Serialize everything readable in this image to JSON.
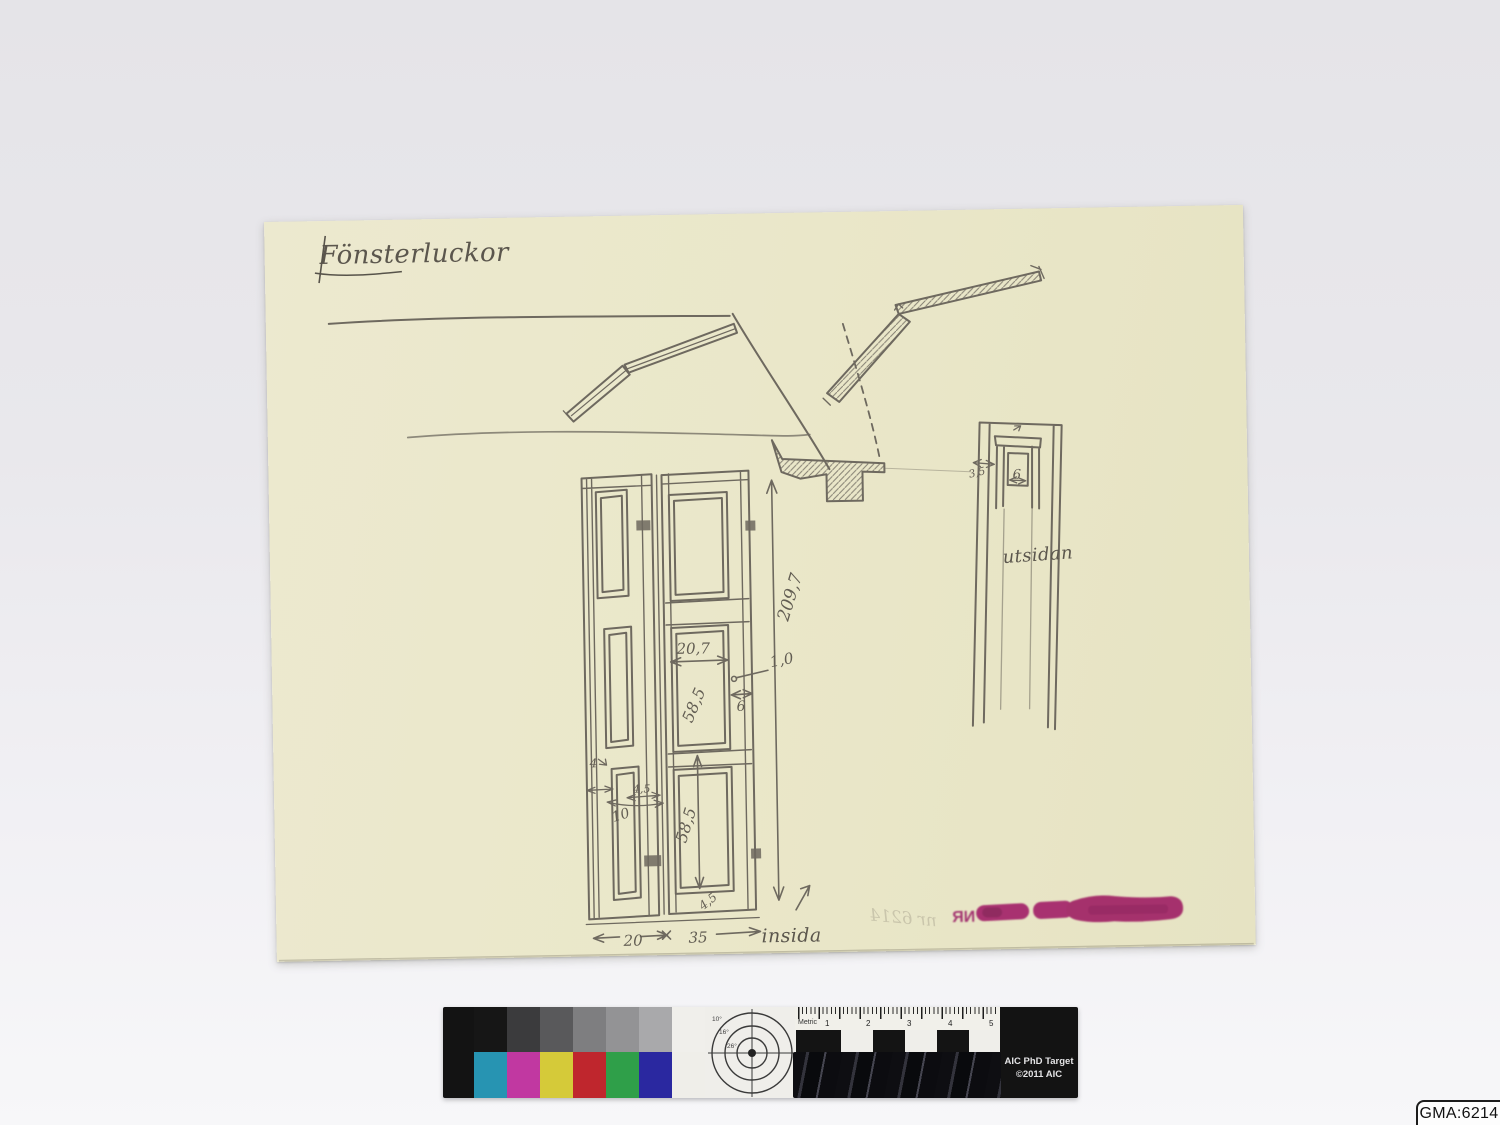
{
  "photo": {
    "background_top": "#e5e4e8",
    "background_bottom": "#f7f7f9"
  },
  "archive_label": {
    "text": "GMA:6214"
  },
  "sketch": {
    "title": "Fönsterluckor",
    "paper_color": "#eae7c9",
    "pencil_color": "#6e695f",
    "labels": {
      "inside": "insida",
      "outside": "utsidan"
    },
    "dimensions": {
      "total_height": "209,7",
      "panel_width": "20,7",
      "gap": "1,0",
      "stile_width": "6",
      "mid_panel_height": "58,5",
      "lower_panel_height": "58,5",
      "frame_edge": "4",
      "small_width": "4,5",
      "small_panel_width": "10",
      "bottom_edge": "4,5",
      "left_leaf_width": "20",
      "right_leaf_width": "35",
      "detail_opening": "6",
      "detail_depth": "3,5"
    },
    "stamp": {
      "mirrored_text": "NR",
      "pencil_note": "nr 6214",
      "ink_color": "#a32369"
    }
  },
  "target": {
    "title": "AIC PhD Target",
    "copyright": "©2011 AIC",
    "ruler_label": "Metric",
    "ruler_numbers": [
      "1",
      "2",
      "3",
      "4",
      "5"
    ],
    "circle_labels": [
      "10°",
      "16°",
      "26°"
    ],
    "gray_swatches": [
      "#161616",
      "#3b3b3d",
      "#59595b",
      "#7e7e80",
      "#939395",
      "#a9a9ab",
      "#f0efeb"
    ],
    "color_swatches": [
      "#2794b2",
      "#c138a1",
      "#d5ca39",
      "#bf262d",
      "#2f9f49",
      "#2a28a0",
      "#efeee9"
    ]
  }
}
